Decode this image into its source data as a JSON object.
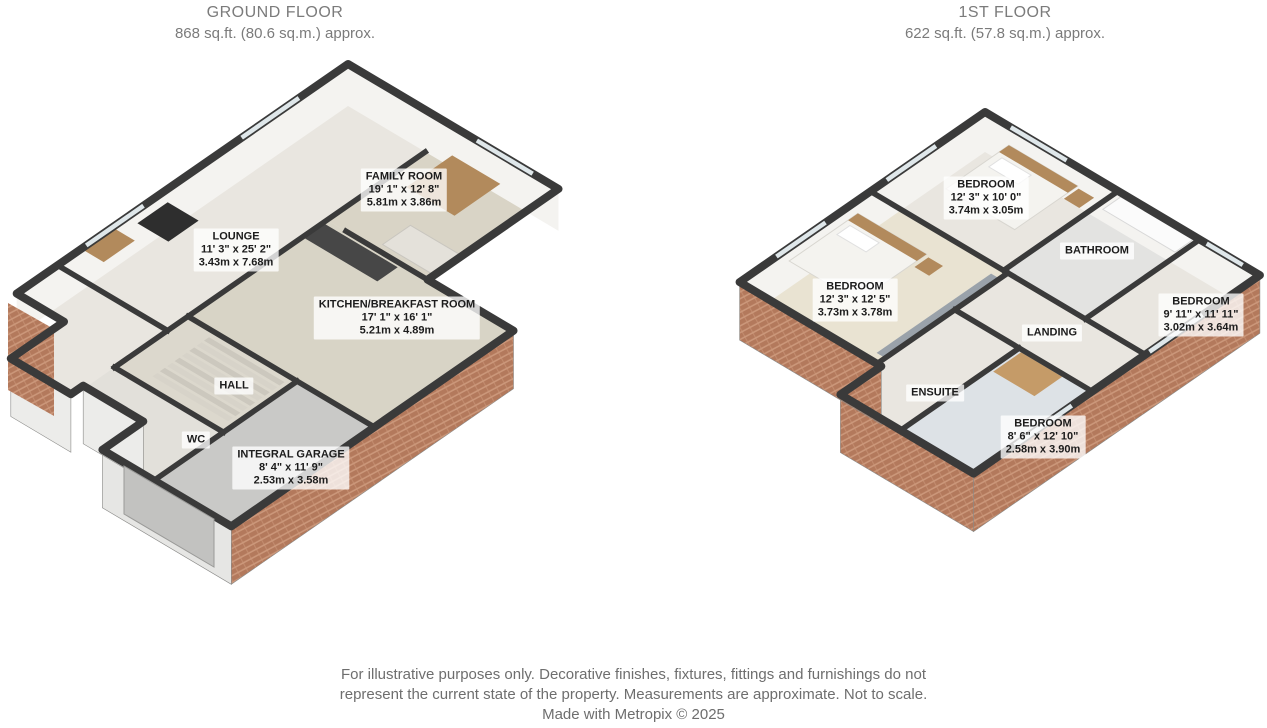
{
  "floors": [
    {
      "title": "GROUND FLOOR",
      "area": "868 sq.ft. (80.6 sq.m.) approx.",
      "rooms": [
        {
          "name": "FAMILY ROOM",
          "dims_ft": "19' 1\" x 12' 8\"",
          "dims_m": "5.81m x 3.86m"
        },
        {
          "name": "LOUNGE",
          "dims_ft": "11' 3\" x 25' 2\"",
          "dims_m": "3.43m x 7.68m"
        },
        {
          "name": "KITCHEN/BREAKFAST ROOM",
          "dims_ft": "17' 1\" x 16' 1\"",
          "dims_m": "5.21m x 4.89m"
        },
        {
          "name": "HALL"
        },
        {
          "name": "WC"
        },
        {
          "name": "INTEGRAL GARAGE",
          "dims_ft": "8' 4\" x 11' 9\"",
          "dims_m": "2.53m x 3.58m"
        }
      ]
    },
    {
      "title": "1ST FLOOR",
      "area": "622 sq.ft. (57.8 sq.m.) approx.",
      "rooms": [
        {
          "name": "BEDROOM",
          "dims_ft": "12' 3\" x 10' 0\"",
          "dims_m": "3.74m x 3.05m"
        },
        {
          "name": "BATHROOM"
        },
        {
          "name": "BEDROOM",
          "dims_ft": "12' 3\" x 12' 5\"",
          "dims_m": "3.73m x 3.78m"
        },
        {
          "name": "BEDROOM",
          "dims_ft": "9' 11\" x 11' 11\"",
          "dims_m": "3.02m x 3.64m"
        },
        {
          "name": "LANDING"
        },
        {
          "name": "ENSUITE"
        },
        {
          "name": "BEDROOM",
          "dims_ft": "8' 6\" x 12' 10\"",
          "dims_m": "2.58m x 3.90m"
        }
      ]
    }
  ],
  "footer": {
    "line1": "For illustrative purposes only. Decorative finishes, fixtures, fittings and furnishings do not",
    "line2": "represent the current state of the property. Measurements are approximate. Not to scale.",
    "line3": "Made with Metropix © 2025"
  },
  "colors": {
    "wall": "#3a3a3a",
    "floor": "#e9e6e0",
    "carpet_beige": "#d9d4c6",
    "kitchen_floor": "#d8d4c6",
    "garage_floor": "#c9c9c7",
    "brick": "#b3795c",
    "brick_light": "#cb977a",
    "wood": "#b28a5c",
    "cream_floor": "#e9e3d2",
    "blue_floor": "#dde2e6",
    "wall_face": "#f4f3f0",
    "window": "#dfe7ea",
    "title_text": "#7b7b7b",
    "footer_text": "#6e6e6e"
  }
}
